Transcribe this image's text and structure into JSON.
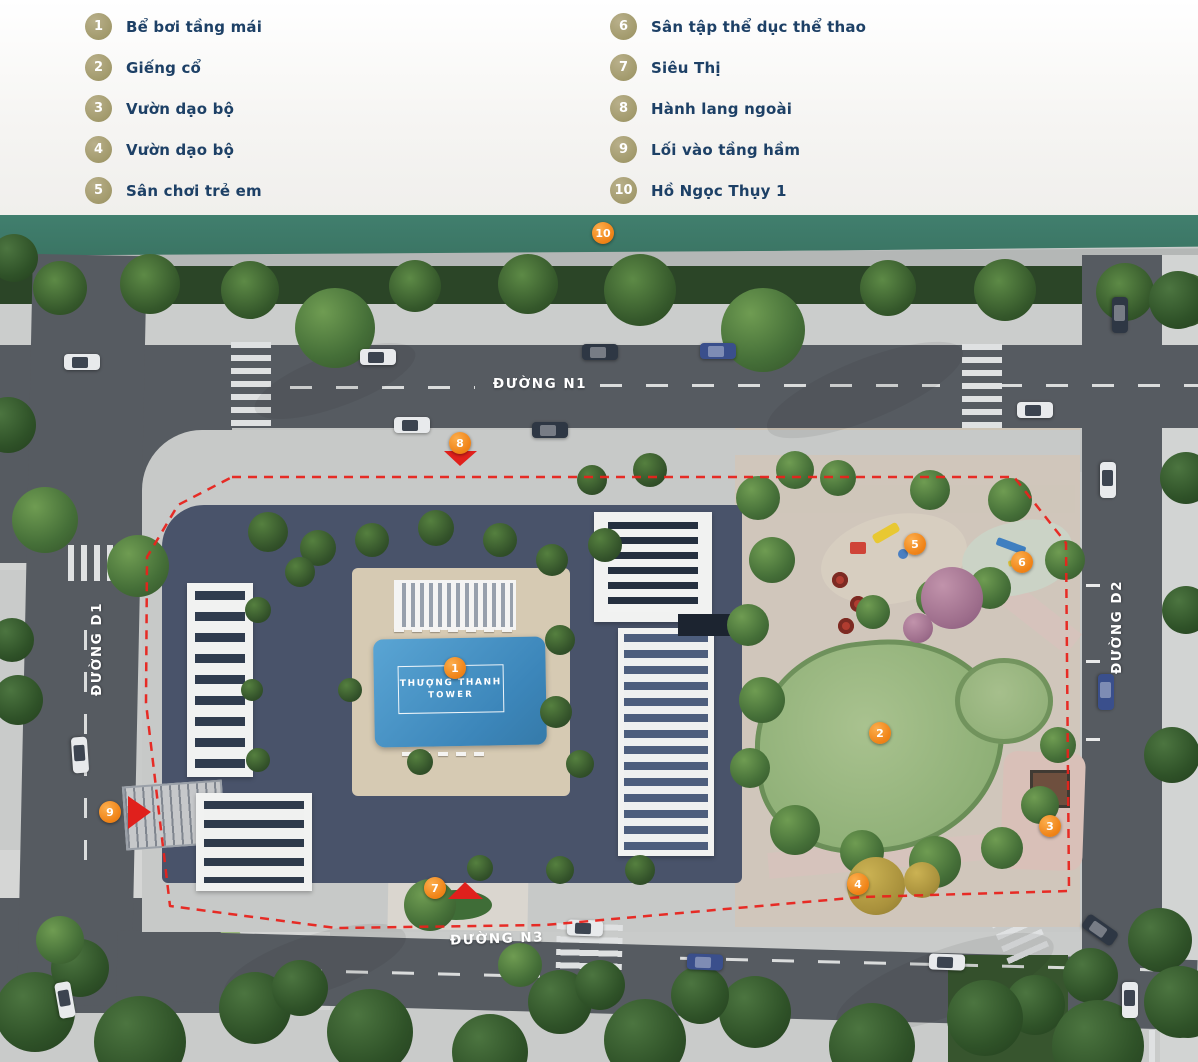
{
  "legend": {
    "items": [
      {
        "num": "1",
        "label": "Bể bơi tầng mái"
      },
      {
        "num": "2",
        "label": "Giếng cổ"
      },
      {
        "num": "3",
        "label": "Vườn dạo bộ"
      },
      {
        "num": "4",
        "label": "Vườn dạo bộ"
      },
      {
        "num": "5",
        "label": "Sân chơi trẻ em"
      },
      {
        "num": "6",
        "label": "Sân tập thể dục thể thao"
      },
      {
        "num": "7",
        "label": "Siêu Thị"
      },
      {
        "num": "8",
        "label": "Hành lang ngoài"
      },
      {
        "num": "9",
        "label": "Lối vào tầng hầm"
      },
      {
        "num": "10",
        "label": "Hồ Ngọc Thụy 1"
      }
    ]
  },
  "map": {
    "roads": {
      "n1": "ĐƯỜNG N1",
      "d1": "ĐƯỜNG D1",
      "d2": "ĐƯỜNG D2",
      "n3": "ĐƯỜNG N3"
    },
    "tower": {
      "line1": "THƯỢNG THANH",
      "line2": "TOWER"
    },
    "markers": [
      {
        "num": "1",
        "x": 455,
        "y": 668
      },
      {
        "num": "2",
        "x": 880,
        "y": 733
      },
      {
        "num": "3",
        "x": 1050,
        "y": 826
      },
      {
        "num": "4",
        "x": 858,
        "y": 884
      },
      {
        "num": "5",
        "x": 915,
        "y": 544
      },
      {
        "num": "6",
        "x": 1022,
        "y": 562
      },
      {
        "num": "7",
        "x": 435,
        "y": 888
      },
      {
        "num": "8",
        "x": 460,
        "y": 443
      },
      {
        "num": "9",
        "x": 110,
        "y": 812
      },
      {
        "num": "10",
        "x": 603,
        "y": 233
      }
    ]
  },
  "colors": {
    "marker_orange": "#f08418",
    "legend_badge": "#a29a6c",
    "legend_text": "#1d4066",
    "boundary_red": "#e8231c",
    "lake_teal": "#3d7c6c",
    "pool_blue": "#4392c5"
  }
}
